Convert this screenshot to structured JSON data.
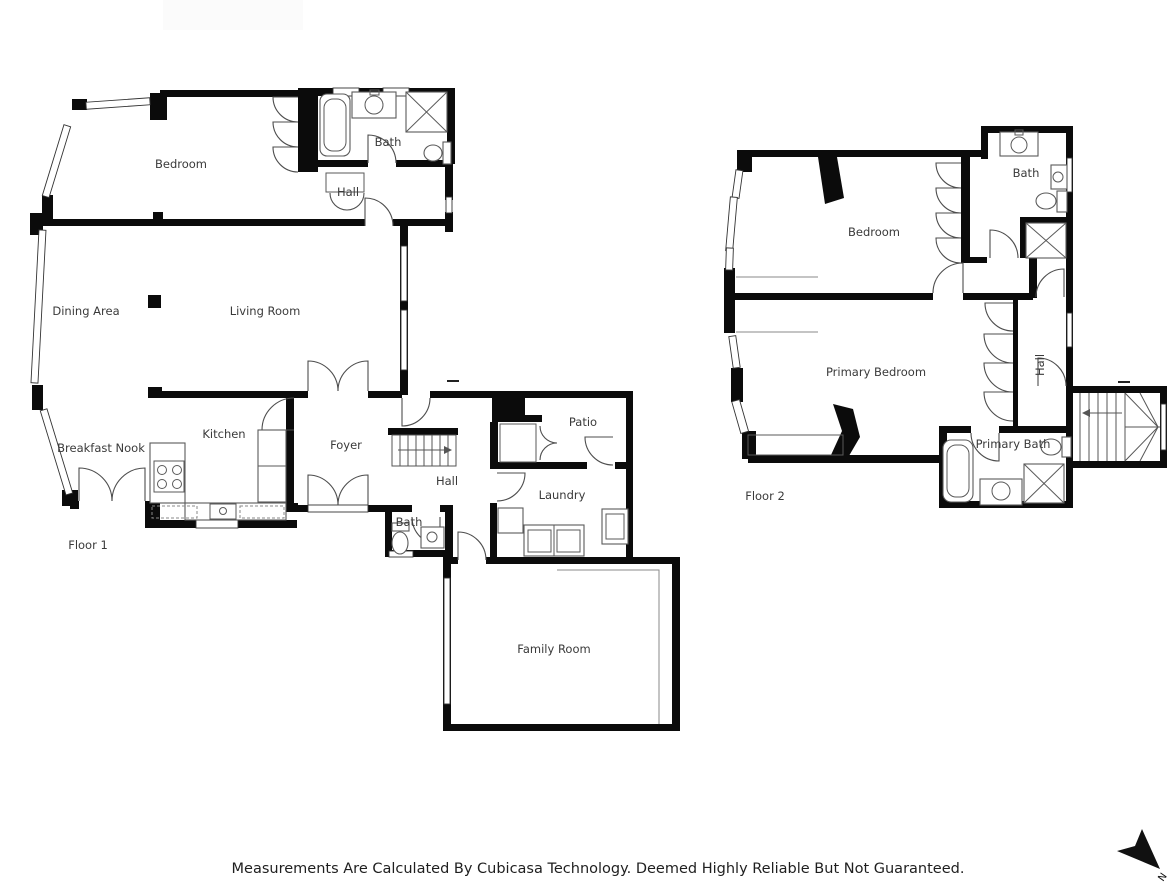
{
  "floor1": {
    "floor_label": "Floor 1",
    "rooms": {
      "bedroom": "Bedroom",
      "bath_upper": "Bath",
      "hall_upper": "Hall",
      "dining": "Dining Area",
      "living": "Living Room",
      "breakfast": "Breakfast Nook",
      "kitchen": "Kitchen",
      "foyer": "Foyer",
      "hall": "Hall",
      "patio": "Patio",
      "laundry": "Laundry",
      "bath_small": "Bath",
      "family": "Family Room"
    }
  },
  "floor2": {
    "floor_label": "Floor 2",
    "rooms": {
      "bath": "Bath",
      "bedroom": "Bedroom",
      "primary_bedroom": "Primary Bedroom",
      "hall": "Hall",
      "primary_bath": "Primary Bath"
    }
  },
  "footer": {
    "disclaimer": "Measurements Are Calculated By Cubicasa Technology. Deemed Highly Reliable But Not Guaranteed."
  },
  "compass": {
    "north_label": "N"
  },
  "colors": {
    "wall": "#0b0b0b",
    "fixture_stroke": "#5a5a5a",
    "door_stroke": "#4d4d4d",
    "label_text": "#3a3a3a",
    "background": "#ffffff"
  }
}
